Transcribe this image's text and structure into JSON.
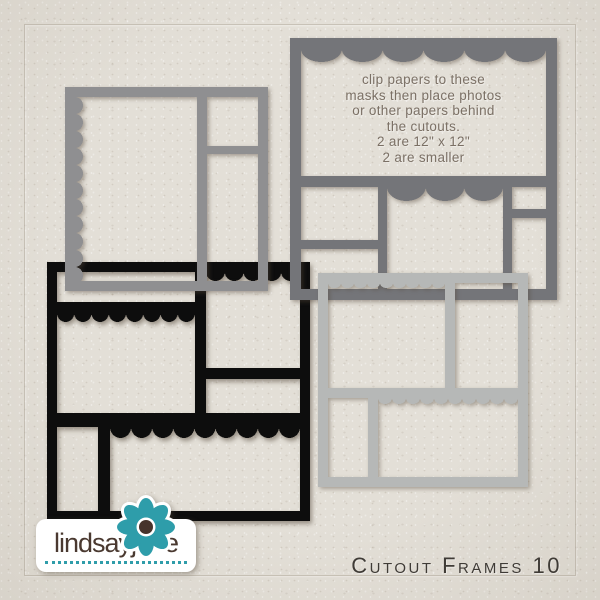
{
  "product": {
    "title": "Cutout Frames 10",
    "brand": "lindsayjane"
  },
  "note": {
    "lines": [
      "clip papers to these",
      "masks then place photos",
      "or other papers behind",
      "the cutouts.",
      "2 are 12\" x 12\"",
      "2 are smaller"
    ]
  },
  "palette": {
    "paper": "#e3dfd7",
    "frame_top_left_gray": "#8f8f91",
    "frame_top_right_dark_gray": "#747579",
    "frame_bottom_left_black": "#0d0d0d",
    "frame_bottom_right_light_gray": "#b6b8b7",
    "note_text": "#7b7065",
    "title_text": "#3f3b36",
    "brand_text": "#4a3930",
    "accent_teal": "#2e9daa",
    "flower_center_brown": "#47332b",
    "logo_background": "#ffffff"
  },
  "icons": {
    "flower": "flower-icon"
  }
}
